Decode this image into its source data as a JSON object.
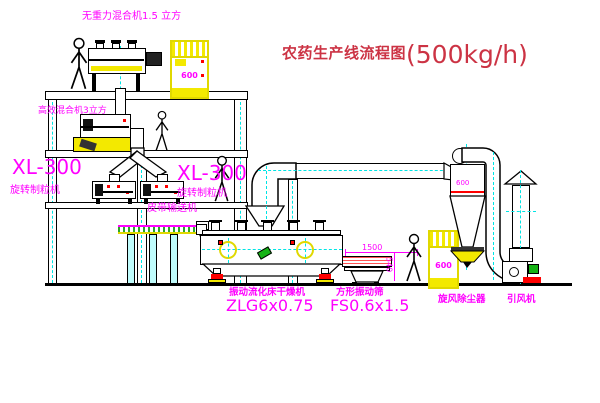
{
  "title": {
    "name": "农药生产线流程图",
    "capacity": "(500kg/h)"
  },
  "equipment_labels": {
    "top_mixer": "无重力混合机1.5 立方",
    "mid_mixer": "高效混合机3立方",
    "granulator_left": {
      "model": "XL-300",
      "name": "旋转制粒机"
    },
    "granulator_right": {
      "model": "XL-300",
      "name": "旋转制粒机"
    },
    "belt_conveyor": "皮带输送机",
    "dryer": {
      "name": "振动流化床干燥机",
      "model": "ZLG6x0.75"
    },
    "screen": {
      "name": "方形振动筛",
      "model": "FS0.6x1.5"
    },
    "cyclone": "旋风除尘器",
    "fan": "引风机"
  },
  "dimensions": {
    "screen_length": "1500",
    "screen_height": "540",
    "cyclone_dia": "600",
    "elevator_top": "600",
    "elevator_right": "600"
  },
  "colors": {
    "label": "#ff00ff",
    "title": "#cc3344",
    "centerline": "#00e5e5",
    "accent_yellow": "#f3e900",
    "accent_red": "#ff0000",
    "accent_green": "#15b315",
    "line": "#000000"
  }
}
